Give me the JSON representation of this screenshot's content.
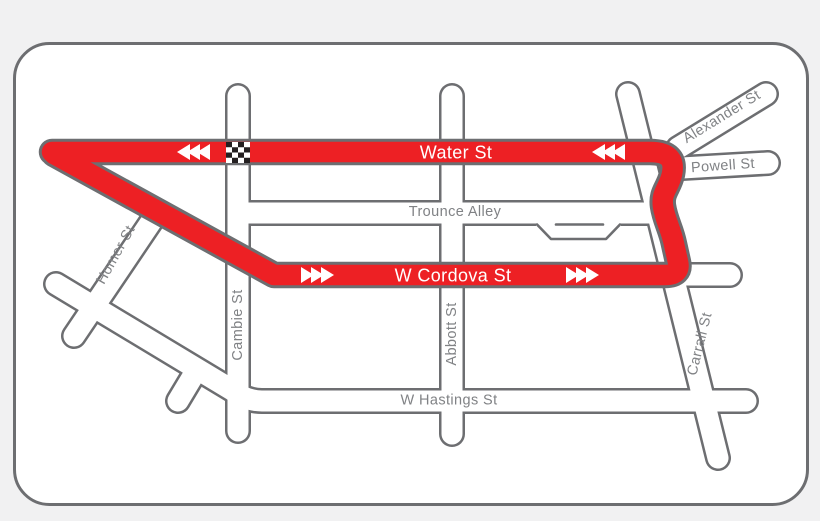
{
  "map": {
    "name": "Gastown criterium race course map",
    "colors": {
      "background": "#f1f1f2",
      "card": "#ffffff",
      "street_casing": "#6d6e71",
      "street_fill": "#ffffff",
      "label_gray": "#808285",
      "route_red": "#ed2024",
      "arrow_white": "#ffffff",
      "checker_black": "#231f20"
    },
    "labels": {
      "water": "Water St",
      "cordova": "W Cordova St",
      "trounce": "Trounce Alley",
      "hastings": "W Hastings St",
      "cambie": "Cambie St",
      "abbott": "Abbott St",
      "carrall": "Carrall St",
      "homer": "Homer St",
      "powell": "Powell St",
      "alexander": "Alexander St"
    },
    "icons": {
      "start_finish": "checkered-flag-strip",
      "water_st_direction": "triple-arrow-left",
      "cordova_st_direction": "triple-arrow-right"
    }
  }
}
